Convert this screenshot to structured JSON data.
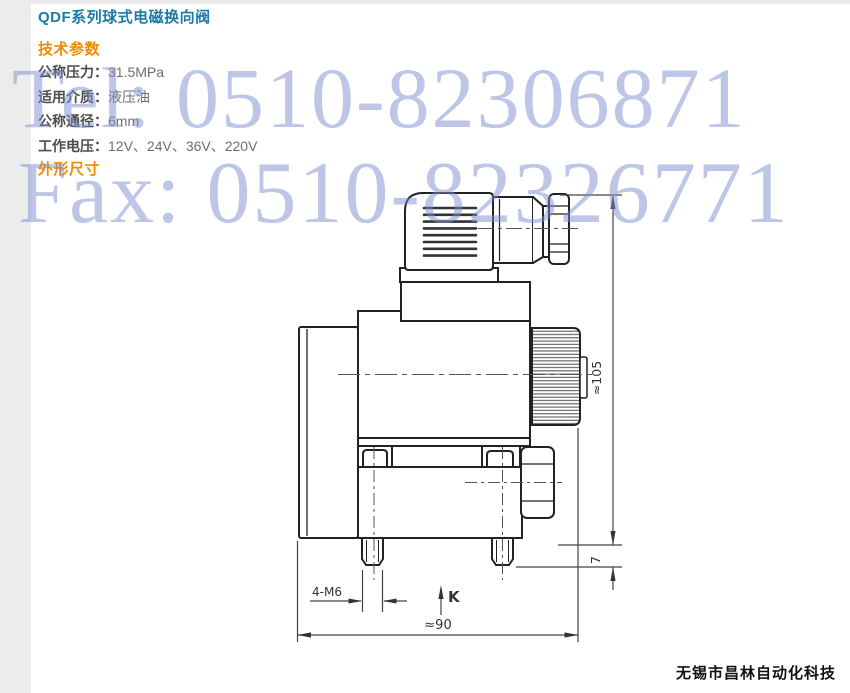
{
  "page": {
    "title": "QDF系列球式电磁换向阀",
    "tech_heading": "技术参数",
    "dim_heading": "外形尺寸",
    "params": [
      {
        "label": "公称压力：",
        "value": "31.5MPa"
      },
      {
        "label": "适用介质：",
        "value": "液压油"
      },
      {
        "label": "公称通径：",
        "value": "6mm"
      },
      {
        "label": "工作电压：",
        "value": "12V、24V、36V、220V"
      }
    ],
    "footer_company": "无锡市昌林自动化科技"
  },
  "watermarks": {
    "tel": "Tel: 0510-82306871",
    "fax": "Fax: 0510-82326771"
  },
  "drawing": {
    "dimensions": {
      "overall_height": "≈105",
      "stud_protrusion": "7",
      "overall_width": "≈90",
      "mounting_thread": "4-M6",
      "port_mark": "K"
    }
  },
  "colors": {
    "title_blue": "#1b7aa6",
    "heading_orange": "#f08a00",
    "watermark_blue": "#7d8fd0",
    "line_dark": "#222222"
  }
}
